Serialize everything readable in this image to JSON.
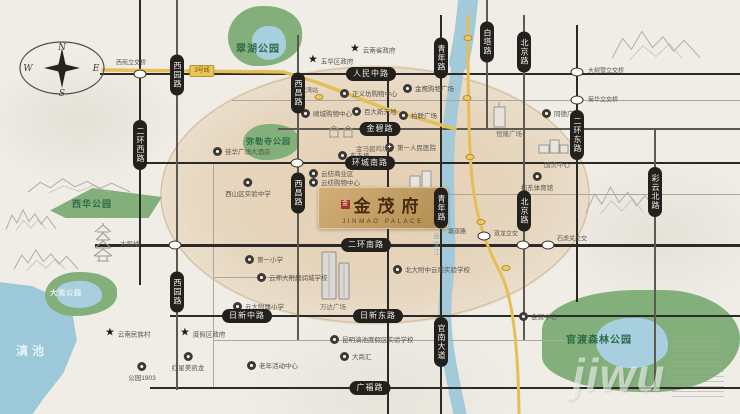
{
  "compass": {
    "n": "N",
    "e": "E",
    "s": "S",
    "w": "W"
  },
  "logo": {
    "seal": "金",
    "name_cn": "金茂府",
    "name_en": "JINMAO PALACE"
  },
  "metro": {
    "badge": "3号线",
    "stations_a": [
      {
        "x": 319,
        "y": 97
      }
    ],
    "stations_b": [
      {
        "x": 468,
        "y": 38
      },
      {
        "x": 467,
        "y": 98
      },
      {
        "x": 470,
        "y": 157
      },
      {
        "x": 481,
        "y": 222
      },
      {
        "x": 506,
        "y": 268
      }
    ]
  },
  "water": {
    "lake_label": "滇池",
    "river_label": "盘龙江"
  },
  "watermark": "jiwu",
  "colors": {
    "park": "#82af7a",
    "lake": "#a7cfe0",
    "road_dark": "#2c2a26",
    "metro": "#e5bf55",
    "core": "#e2c9a8",
    "gold": "#c29c62",
    "seal_red": "#a33524"
  },
  "parks": [
    {
      "id": "cuihu",
      "label": "翠湖公园",
      "x": 228,
      "y": 6,
      "w": 74,
      "h": 60,
      "fs": 10,
      "lx": 236,
      "ly": 40,
      "style": "dark",
      "lake": {
        "x": 252,
        "y": 26,
        "w": 34,
        "h": 34
      }
    },
    {
      "id": "milesi",
      "label": "弥勒寺公园",
      "x": 243,
      "y": 124,
      "w": 56,
      "h": 36,
      "fs": 8,
      "lx": 246,
      "ly": 136,
      "style": "dark"
    },
    {
      "id": "xihua",
      "label": "西华公园",
      "x": 50,
      "y": 188,
      "w": 112,
      "h": 30,
      "fs": 9,
      "lx": 72,
      "ly": 197,
      "style": "dark"
    },
    {
      "id": "daguan",
      "label": "大观公园",
      "x": 45,
      "y": 272,
      "w": 72,
      "h": 44,
      "fs": 7,
      "lx": 50,
      "ly": 288,
      "style": "light",
      "lake": {
        "x": 56,
        "y": 281,
        "w": 46,
        "h": 27
      }
    },
    {
      "id": "guandu",
      "label": "官渡森林公园",
      "x": 542,
      "y": 290,
      "w": 198,
      "h": 102,
      "fs": 10,
      "lx": 566,
      "ly": 331,
      "style": "dark",
      "lake": {
        "x": 596,
        "y": 318,
        "w": 72,
        "h": 50
      }
    }
  ],
  "roads_h": [
    {
      "y": 74,
      "x1": 100,
      "x2": 740,
      "w": 2.5,
      "tone": "dark",
      "pills": [
        {
          "x": 371,
          "label": "人民中路"
        }
      ]
    },
    {
      "y": 100,
      "x1": 232,
      "x2": 740,
      "w": 1,
      "tone": "light",
      "pills": []
    },
    {
      "y": 129,
      "x1": 278,
      "x2": 740,
      "w": 1.5,
      "tone": "mid",
      "pills": [
        {
          "x": 380,
          "label": "金碧路"
        }
      ]
    },
    {
      "y": 163,
      "x1": 138,
      "x2": 740,
      "w": 2.5,
      "tone": "dark",
      "pills": [
        {
          "x": 370,
          "label": "环城南路"
        }
      ]
    },
    {
      "y": 194,
      "x1": 400,
      "x2": 740,
      "w": 1,
      "tone": "light",
      "pills": []
    },
    {
      "y": 245,
      "x1": 95,
      "x2": 740,
      "w": 3,
      "tone": "dark",
      "pills": [
        {
          "x": 366,
          "label": "二环南路"
        }
      ]
    },
    {
      "y": 277,
      "x1": 213,
      "x2": 302,
      "w": 1,
      "tone": "light",
      "pills": []
    },
    {
      "y": 316,
      "x1": 170,
      "x2": 740,
      "w": 2.5,
      "tone": "dark",
      "pills": [
        {
          "x": 247,
          "label": "日新中路"
        },
        {
          "x": 378,
          "label": "日新东路"
        }
      ]
    },
    {
      "y": 340,
      "x1": 213,
      "x2": 565,
      "w": 1,
      "tone": "light",
      "pills": []
    },
    {
      "y": 388,
      "x1": 150,
      "x2": 740,
      "w": 2.5,
      "tone": "dark",
      "pills": [
        {
          "x": 370,
          "label": "广福路"
        }
      ]
    }
  ],
  "roads_v": [
    {
      "x": 140,
      "y1": 0,
      "y2": 285,
      "w": 2.5,
      "tone": "dark",
      "pills": [
        {
          "y": 145,
          "label": "二环西路"
        }
      ]
    },
    {
      "x": 177,
      "y1": 0,
      "y2": 390,
      "w": 1.5,
      "tone": "mid",
      "pills": [
        {
          "y": 75,
          "label": "西园路"
        },
        {
          "y": 292,
          "label": "西园路"
        }
      ]
    },
    {
      "x": 213,
      "y1": 163,
      "y2": 388,
      "w": 1,
      "tone": "light",
      "pills": []
    },
    {
      "x": 298,
      "y1": 35,
      "y2": 340,
      "w": 1.5,
      "tone": "mid",
      "pills": [
        {
          "y": 93,
          "label": "西昌路"
        },
        {
          "y": 193,
          "label": "西昌路"
        }
      ]
    },
    {
      "x": 388,
      "y1": 74,
      "y2": 414,
      "w": 2.5,
      "tone": "dark",
      "pills": []
    },
    {
      "x": 441,
      "y1": 15,
      "y2": 414,
      "w": 2,
      "tone": "dark",
      "pills": [
        {
          "y": 58,
          "label": "青年路"
        },
        {
          "y": 208,
          "label": "青年路"
        },
        {
          "y": 342,
          "label": "官南大道"
        }
      ]
    },
    {
      "x": 487,
      "y1": 0,
      "y2": 130,
      "w": 1.5,
      "tone": "mid",
      "pills": [
        {
          "y": 42,
          "label": "白塔路"
        }
      ]
    },
    {
      "x": 524,
      "y1": 15,
      "y2": 340,
      "w": 1.5,
      "tone": "mid",
      "pills": [
        {
          "y": 52,
          "label": "北京路"
        },
        {
          "y": 211,
          "label": "北京路"
        }
      ]
    },
    {
      "x": 577,
      "y1": 25,
      "y2": 302,
      "w": 2.5,
      "tone": "dark",
      "pills": [
        {
          "y": 135,
          "label": "二环东路"
        }
      ]
    },
    {
      "x": 655,
      "y1": 128,
      "y2": 390,
      "w": 1.2,
      "tone": "mid",
      "pills": [
        {
          "y": 192,
          "label": "彩云北路"
        }
      ]
    }
  ],
  "junctions": [
    {
      "x": 140,
      "y": 74,
      "label": "西苑立交桥",
      "lx": 116,
      "ly": 62
    },
    {
      "x": 297,
      "y": 163,
      "label": ""
    },
    {
      "x": 175,
      "y": 245,
      "label": ""
    },
    {
      "x": 577,
      "y": 72,
      "label": "大树营立交桥",
      "lx": 588,
      "ly": 70
    },
    {
      "x": 577,
      "y": 100,
      "label": "菊华立交桥",
      "lx": 588,
      "ly": 99
    },
    {
      "x": 484,
      "y": 236,
      "label": ""
    },
    {
      "x": 523,
      "y": 245,
      "label": "双龙立交",
      "lx": 494,
      "ly": 233
    },
    {
      "x": 548,
      "y": 245,
      "label": "石虎关立交",
      "lx": 557,
      "ly": 238
    }
  ],
  "minor_labels": [
    {
      "x": 448,
      "y": 231,
      "label": "塘双路"
    },
    {
      "x": 294,
      "y": 90,
      "label": "潘家湾站"
    }
  ],
  "pois": [
    {
      "t": "star",
      "x": 355,
      "y": 49,
      "label": "云南省政府"
    },
    {
      "t": "star",
      "x": 313,
      "y": 60,
      "label": "五华区政府"
    },
    {
      "t": "dot",
      "x": 345,
      "y": 93,
      "label": "正义坊购物中心"
    },
    {
      "t": "dot",
      "x": 408,
      "y": 88,
      "label": "金鹰购物广场"
    },
    {
      "t": "dot",
      "x": 306,
      "y": 113,
      "label": "顺城购物中心"
    },
    {
      "t": "dot",
      "x": 357,
      "y": 111,
      "label": "百大新天地"
    },
    {
      "t": "dot",
      "x": 404,
      "y": 115,
      "label": "柏联广场"
    },
    {
      "t": "hosp",
      "x": 390,
      "y": 147,
      "label": "第一人民医院"
    },
    {
      "t": "dot",
      "x": 343,
      "y": 155,
      "label": "东寺塔"
    },
    {
      "t": "dot",
      "x": 218,
      "y": 151,
      "label": "佳华广场大酒店"
    },
    {
      "t": "dot",
      "x": 248,
      "y": 182,
      "label": "西山区实验中学",
      "lpos": "b"
    },
    {
      "t": "dot",
      "x": 314,
      "y": 173,
      "label": "云纺商业区"
    },
    {
      "t": "dot",
      "x": 314,
      "y": 182,
      "label": "云纺购物中心"
    },
    {
      "t": "dot",
      "x": 537,
      "y": 176,
      "label": "拓东体育馆",
      "lpos": "b"
    },
    {
      "t": "dot",
      "x": 547,
      "y": 113,
      "label": "同德广场"
    },
    {
      "t": "dot",
      "x": 250,
      "y": 259,
      "label": "第一小学"
    },
    {
      "t": "dot",
      "x": 262,
      "y": 277,
      "label": "云师大附属润城学校"
    },
    {
      "t": "dot",
      "x": 238,
      "y": 306,
      "label": "云大附属小学"
    },
    {
      "t": "dot",
      "x": 398,
      "y": 269,
      "label": "北大附中云南实验学校"
    },
    {
      "t": "dot",
      "x": 335,
      "y": 339,
      "label": "昆明滇池度假区实验学校"
    },
    {
      "t": "dot",
      "x": 345,
      "y": 356,
      "label": "大商汇"
    },
    {
      "t": "dot",
      "x": 252,
      "y": 365,
      "label": "老年活动中心"
    },
    {
      "t": "dot",
      "x": 142,
      "y": 366,
      "label": "公园1903",
      "lpos": "b"
    },
    {
      "t": "star",
      "x": 110,
      "y": 333,
      "label": "云南民族村"
    },
    {
      "t": "star",
      "x": 185,
      "y": 333,
      "label": "度假区政府"
    },
    {
      "t": "dot",
      "x": 188,
      "y": 356,
      "label": "红星美凯龙",
      "lpos": "b"
    },
    {
      "t": "dot",
      "x": 524,
      "y": 316,
      "label": "会展中心"
    }
  ],
  "buildings": [
    {
      "id": "jinma",
      "label": "金马碧鸡坊",
      "bx": 328,
      "by": 124,
      "lx": 356,
      "ly": 143,
      "kind": "gate"
    },
    {
      "id": "dayuecheng",
      "label": "大悦城",
      "bx": 408,
      "by": 168,
      "lx": 414,
      "ly": 196,
      "kind": "towers2"
    },
    {
      "id": "henglong",
      "label": "恒隆广场",
      "bx": 490,
      "by": 102,
      "lx": 496,
      "ly": 128,
      "kind": "tower1"
    },
    {
      "id": "guomao",
      "label": "国贸中心",
      "bx": 538,
      "by": 136,
      "lx": 544,
      "ly": 159,
      "kind": "boxes"
    },
    {
      "id": "wanda",
      "label": "万达广场",
      "bx": 316,
      "by": 250,
      "lx": 320,
      "ly": 301,
      "kind": "wanda"
    },
    {
      "id": "daguanlou",
      "label": "大观楼",
      "bx": 90,
      "by": 222,
      "lx": 120,
      "ly": 238,
      "kind": "pagoda"
    }
  ],
  "mountains": [
    {
      "x": 612,
      "y": 26,
      "w": 88,
      "h": 36
    },
    {
      "x": 28,
      "y": 176,
      "w": 102,
      "h": 18
    },
    {
      "x": 6,
      "y": 206,
      "w": 50,
      "h": 26
    },
    {
      "x": 14,
      "y": 246,
      "w": 64,
      "h": 26
    },
    {
      "x": 586,
      "y": 182,
      "w": 72,
      "h": 34
    }
  ]
}
